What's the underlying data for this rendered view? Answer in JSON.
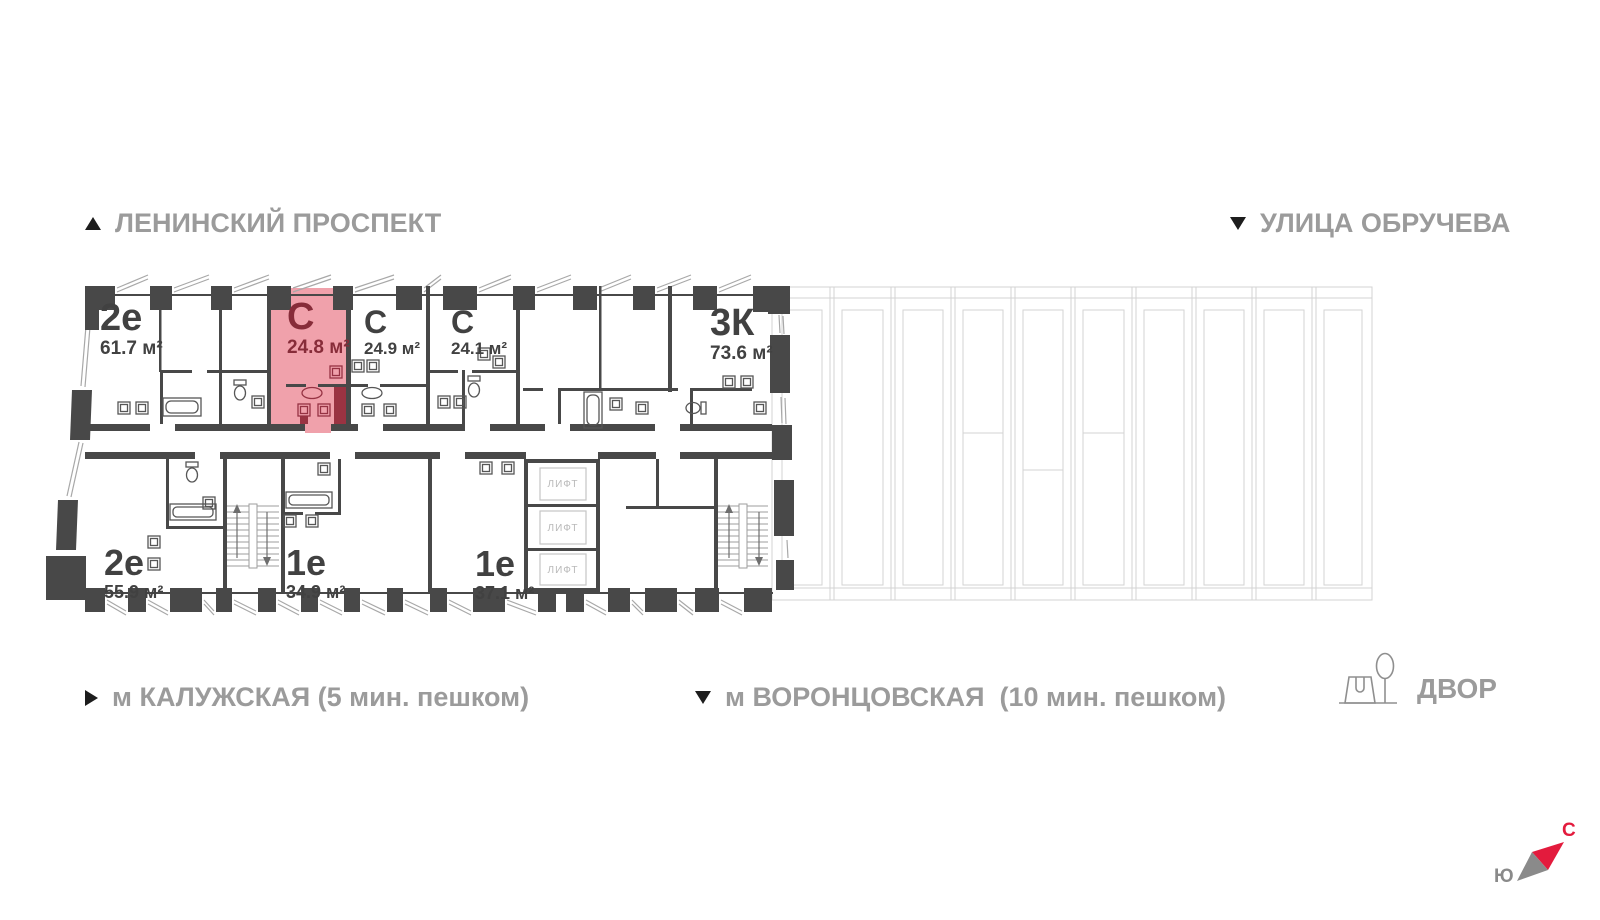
{
  "streets": {
    "top_left": {
      "label": "ЛЕНИНСКИЙ ПРОСПЕКТ",
      "direction_icon": "triangle-up"
    },
    "top_right": {
      "label": "УЛИЦА ОБРУЧЕВА",
      "direction_icon": "triangle-down"
    }
  },
  "metro": {
    "left": {
      "label": "м КАЛУЖСКАЯ (5 мин. пешком)",
      "direction_icon": "triangle-right"
    },
    "center": {
      "label": "м ВОРОНЦОВСКАЯ  (10 мин. пешком)",
      "direction_icon": "triangle-down"
    }
  },
  "yard": {
    "label": "ДВОР",
    "icon": "yard-playground-tree-icon"
  },
  "compass": {
    "north_label": "С",
    "south_label": "Ю"
  },
  "apartments": [
    {
      "type": "2е",
      "area": "61.7 м²",
      "row": "top",
      "highlighted": false
    },
    {
      "type": "С",
      "area": "24.8 м²",
      "row": "top",
      "highlighted": true
    },
    {
      "type": "С",
      "area": "24.9 м²",
      "row": "top",
      "highlighted": false
    },
    {
      "type": "С",
      "area": "24.1 м²",
      "row": "top",
      "highlighted": false
    },
    {
      "type": "3К",
      "area": "73.6 м²",
      "row": "top",
      "highlighted": false
    },
    {
      "type": "2е",
      "area": "55.9 м²",
      "row": "bottom",
      "highlighted": false
    },
    {
      "type": "1е",
      "area": "34.9 м²",
      "row": "bottom",
      "highlighted": false
    },
    {
      "type": "1е",
      "area": "37.1 м²",
      "row": "bottom",
      "highlighted": false
    }
  ],
  "lifts": {
    "label": "ЛИФТ",
    "count": 3
  },
  "colors": {
    "wall": "#484848",
    "highlight_fill": "#f0a1ab",
    "highlight_accent": "#9a3342",
    "highlight_text": "#872c39",
    "unit_text": "#414141",
    "street_text": "#9b9b9b",
    "light_line": "#d3d3d3",
    "lift_text": "#b9b9b9",
    "compass_north": "#e31b3d",
    "compass_south": "#8a8a8a"
  }
}
